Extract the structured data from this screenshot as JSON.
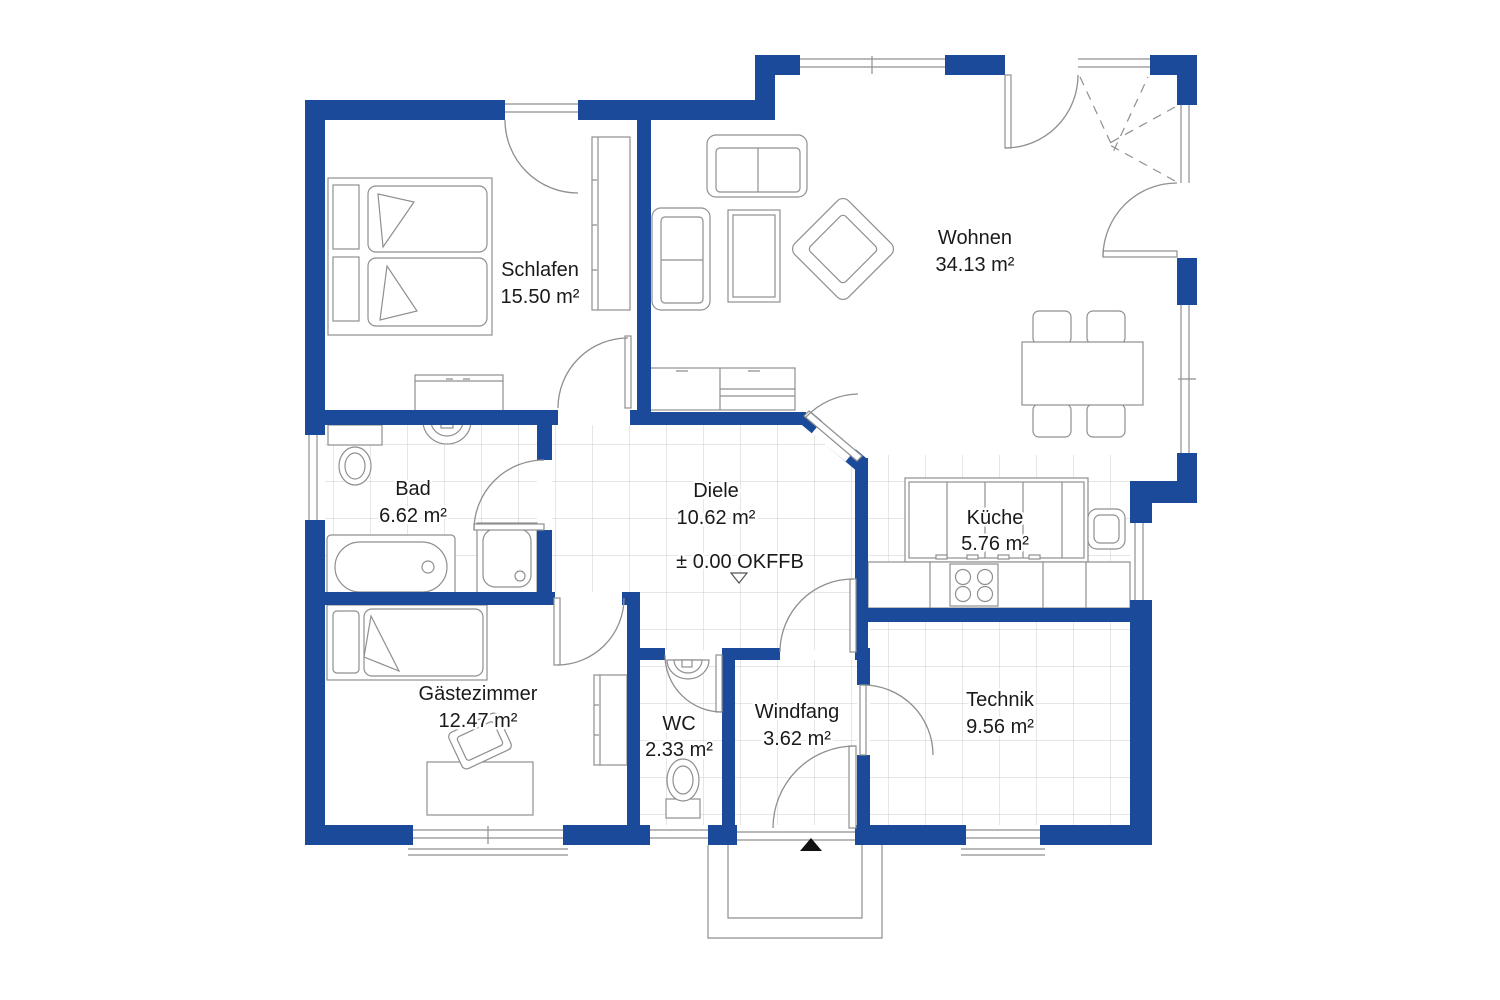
{
  "plan": {
    "rooms": [
      {
        "name": "Schlafen",
        "area": "15.50 m²"
      },
      {
        "name": "Wohnen",
        "area": "34.13 m²"
      },
      {
        "name": "Bad",
        "area": "6.62 m²"
      },
      {
        "name": "Diele",
        "area": "10.62 m²"
      },
      {
        "name": "Küche",
        "area": "5.76 m²"
      },
      {
        "name": "Gästezimmer",
        "area": "12.47 m²"
      },
      {
        "name": "WC",
        "area": "2.33 m²"
      },
      {
        "name": "Windfang",
        "area": "3.62 m²"
      },
      {
        "name": "Technik",
        "area": "9.56 m²"
      }
    ],
    "level_marker": "± 0.00 OKFFB",
    "colors": {
      "wall": "#1B4A9B",
      "line": "#8F8F8F",
      "tile": "#CCCCCC",
      "text": "#1A1A1A",
      "background": "#FFFFFF",
      "entrance_marker": "#111111"
    }
  }
}
